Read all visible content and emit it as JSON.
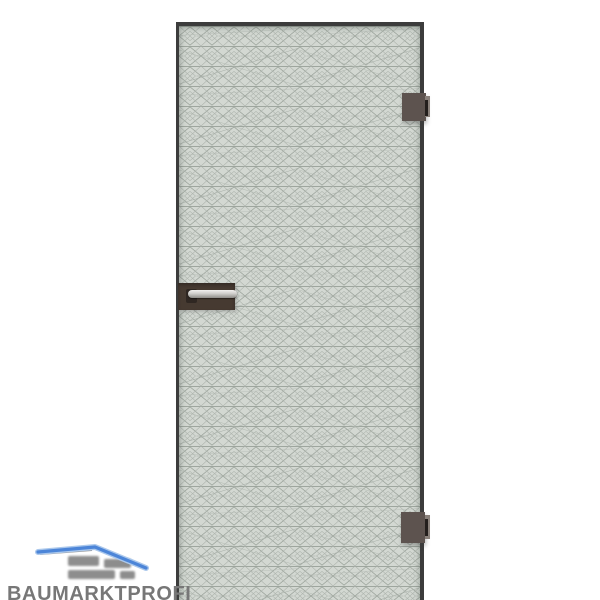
{
  "page": {
    "background_color": "#ffffff"
  },
  "product_image": {
    "description": "Frameless glass door with etched diamond-lattice pattern, dark bronze clamp hinges on the right edge and a lever handle on the left",
    "door": {
      "frame_color": "#3c3c3c",
      "glass_color": "#d3d8d2",
      "pattern_line_color": "#9aa19a",
      "pattern_name": "diamond-lattice"
    },
    "fittings": {
      "hinge_color": "#5d534f",
      "hinge_slot_color": "#241f1d",
      "handle_plate_color": "#463a31",
      "lever_color": "#cfcecb"
    }
  },
  "watermark": {
    "brand": "BAUMARKTPROFI",
    "brand_color": "#777777",
    "roof_color": "#4c85d8"
  }
}
